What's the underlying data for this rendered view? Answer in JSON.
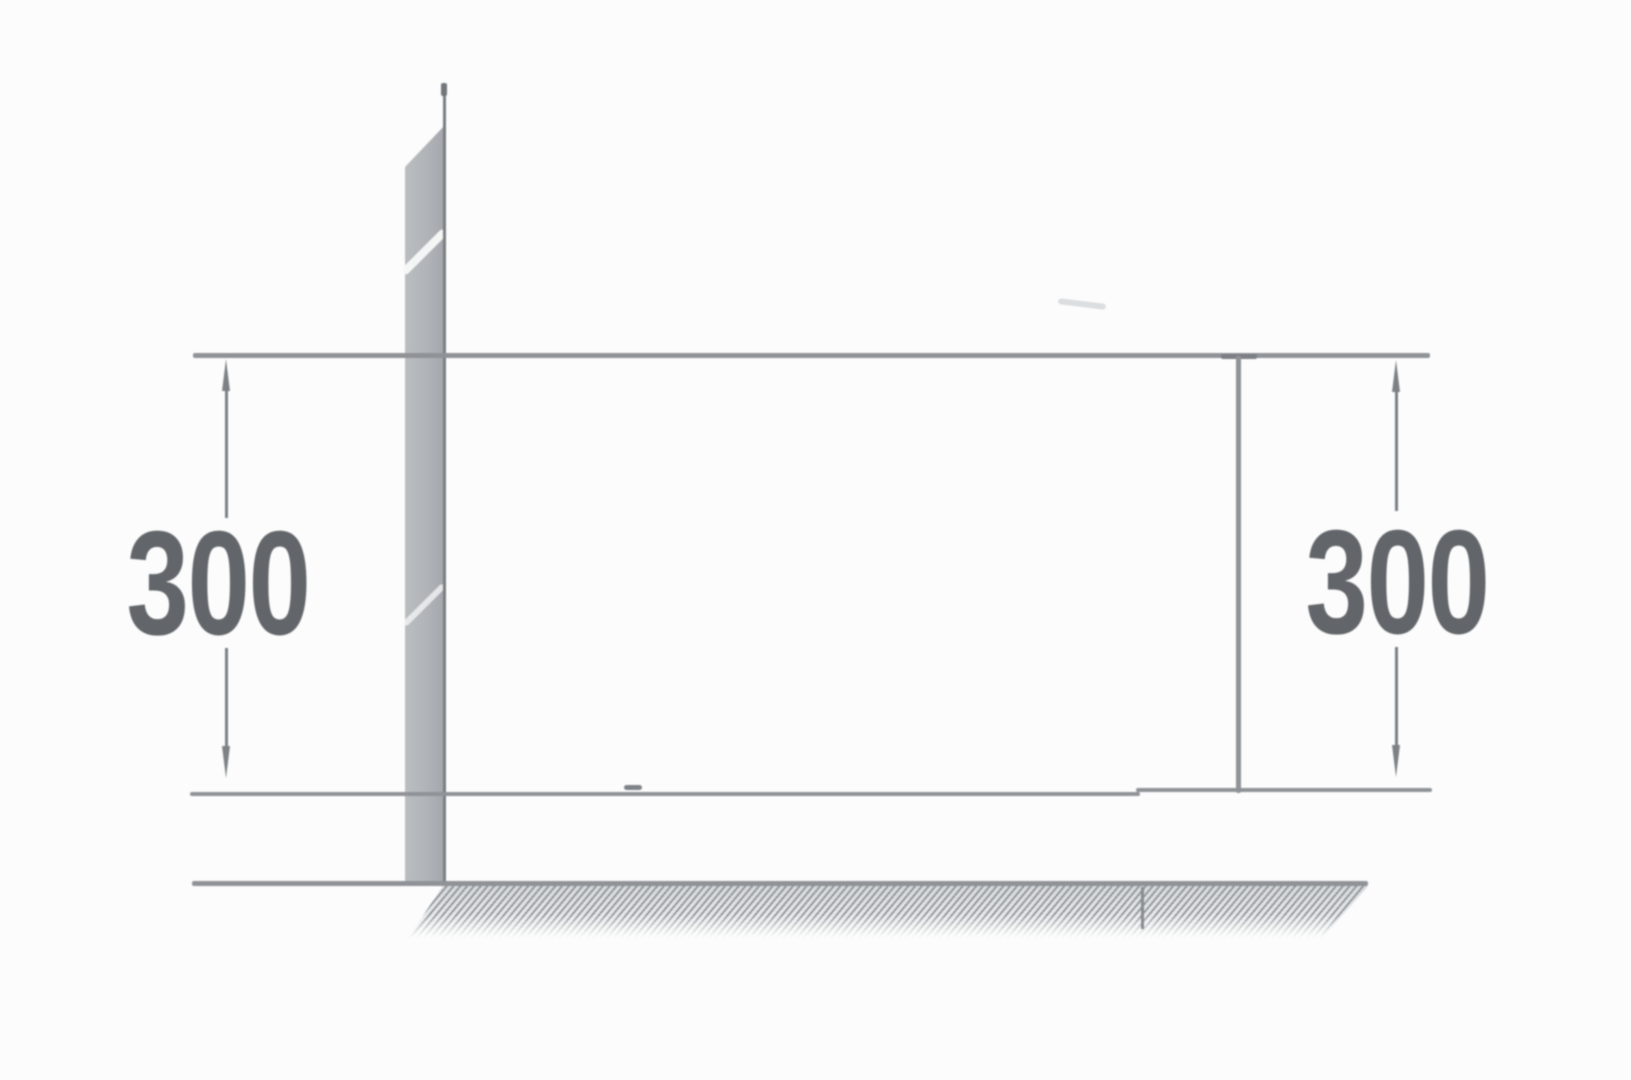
{
  "diagram": {
    "labels": {
      "left_dimension": "300",
      "right_dimension": "300"
    },
    "colors": {
      "background": "#fcfcfc",
      "line": "#8f9397",
      "line-dark": "#7b7f83",
      "arrow": "#7d8185",
      "text": "#62666a",
      "wall-fill-light": "#babdc0",
      "wall-fill-dark": "#a3a7ab",
      "hatch": "#8a9096"
    }
  }
}
